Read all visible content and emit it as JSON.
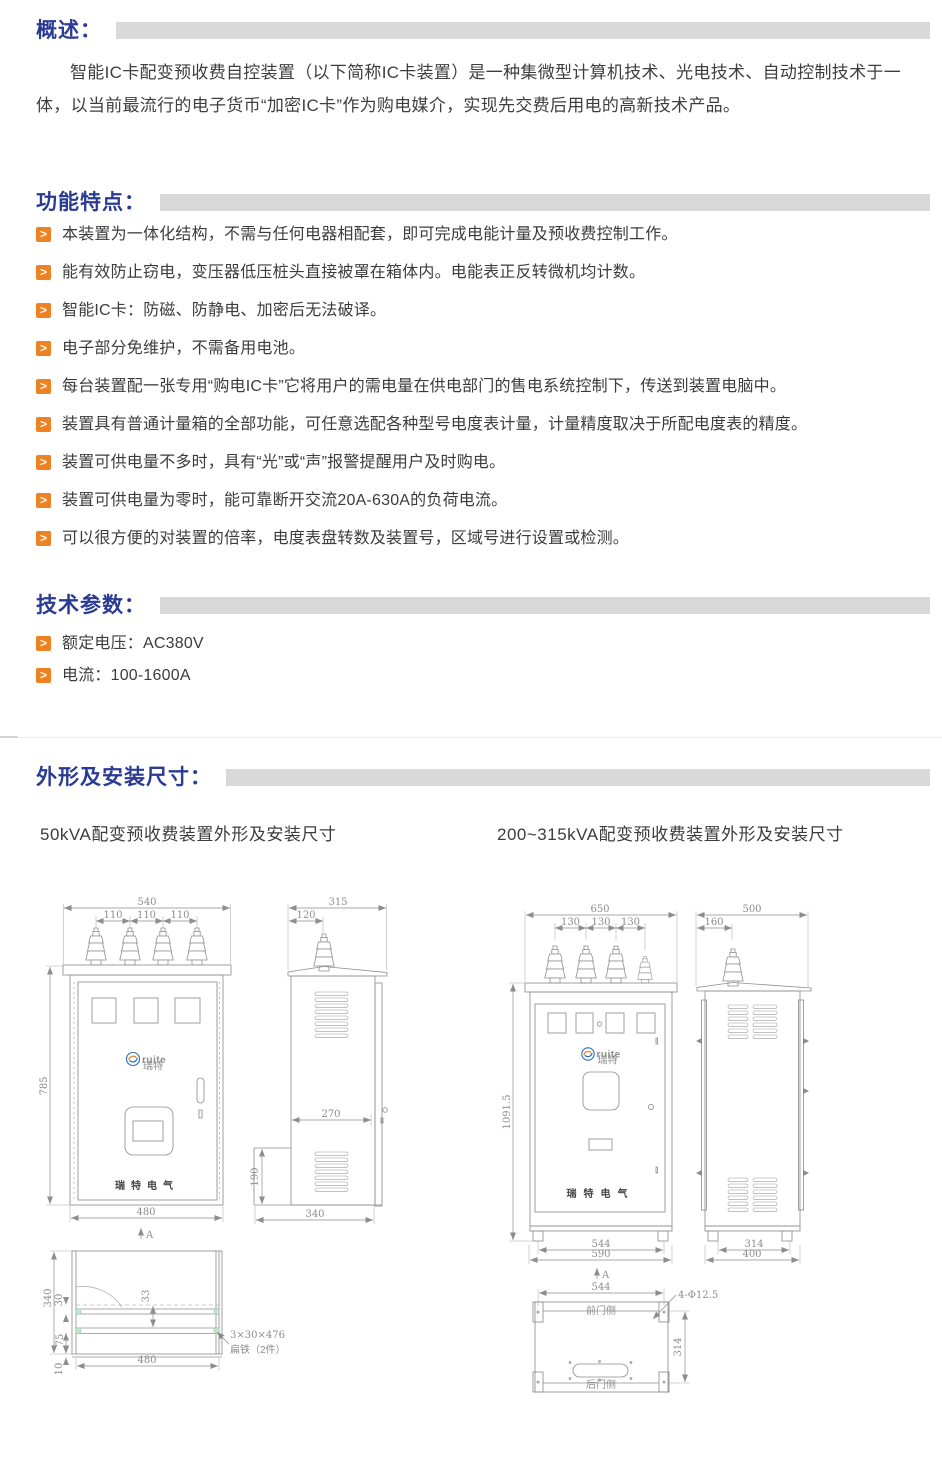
{
  "colors": {
    "heading_blue": "#2a3b94",
    "bar_gray": "#d9d9d9",
    "bullet_orange": "#ee8222",
    "logo_blue": "#2a6db8",
    "logo_orange": "#f08221"
  },
  "icons": {
    "bullet_glyph": ">"
  },
  "overview": {
    "title": "概述：",
    "paragraph": "智能IC卡配变预收费自控装置（以下简称IC卡装置）是一种集微型计算机技术、光电技术、自动控制技术于一体，以当前最流行的电子货币“加密IC卡”作为购电媒介，实现先交费后用电的高新技术产品。"
  },
  "features": {
    "title": "功能特点：",
    "items": [
      "本装置为一体化结构，不需与任何电器相配套，即可完成电能计量及预收费控制工作。",
      "能有效防止窃电，变压器低压桩头直接被罩在箱体内。电能表正反转微机均计数。",
      "智能IC卡：防磁、防静电、加密后无法破译。",
      "电子部分免维护，不需备用电池。",
      "每台装置配一张专用“购电IC卡”它将用户的需电量在供电部门的售电系统控制下，传送到装置电脑中。",
      "装置具有普通计量箱的全部功能，可任意选配各种型号电度表计量，计量精度取决于所配电度表的精度。",
      "装置可供电量不多时，具有“光”或“声”报警提醒用户及时购电。",
      "装置可供电量为零时，能可靠断开交流20A-630A的负荷电流。",
      "可以很方便的对装置的倍率，电度表盘转数及装置号，区域号进行设置或检测。"
    ]
  },
  "specs": {
    "title": "技术参数：",
    "items": [
      "额定电压：AC380V",
      "电流：100-1600A"
    ]
  },
  "dims": {
    "title": "外形及安装尺寸：",
    "left_caption": "50kVA配变预收费装置外形及安装尺寸",
    "right_caption": "200~315kVA配变预收费装置外形及安装尺寸",
    "brand": "瑞特电气",
    "logo_text": "ruite",
    "logo_sub": "瑞特",
    "arrow_label": "A",
    "left": {
      "front": {
        "w_top": "540",
        "s1": "110",
        "s2": "110",
        "s3": "110",
        "h": "785",
        "w_bottom": "480"
      },
      "side": {
        "w_top": "315",
        "w_offset": "120",
        "d_mid": "270",
        "d_lower": "190",
        "w_bottom": "340"
      },
      "bottom": {
        "h": "340",
        "d30": "30",
        "d75": "75",
        "d10": "10",
        "d33": "33",
        "w": "480",
        "note1": "3×30×476",
        "note2": "扁铁（2件）"
      }
    },
    "right": {
      "front": {
        "w_top": "650",
        "s1": "130",
        "s2": "130",
        "s3": "130",
        "h": "1091.5",
        "w_b1": "544",
        "w_b2": "590"
      },
      "side": {
        "w_top": "500",
        "w_offset": "160",
        "w_b1": "314",
        "w_b2": "400"
      },
      "bottom": {
        "w": "544",
        "front_side": "前门侧",
        "back_side": "后门侧",
        "holes": "4-Φ12.5",
        "h": "314"
      }
    }
  }
}
